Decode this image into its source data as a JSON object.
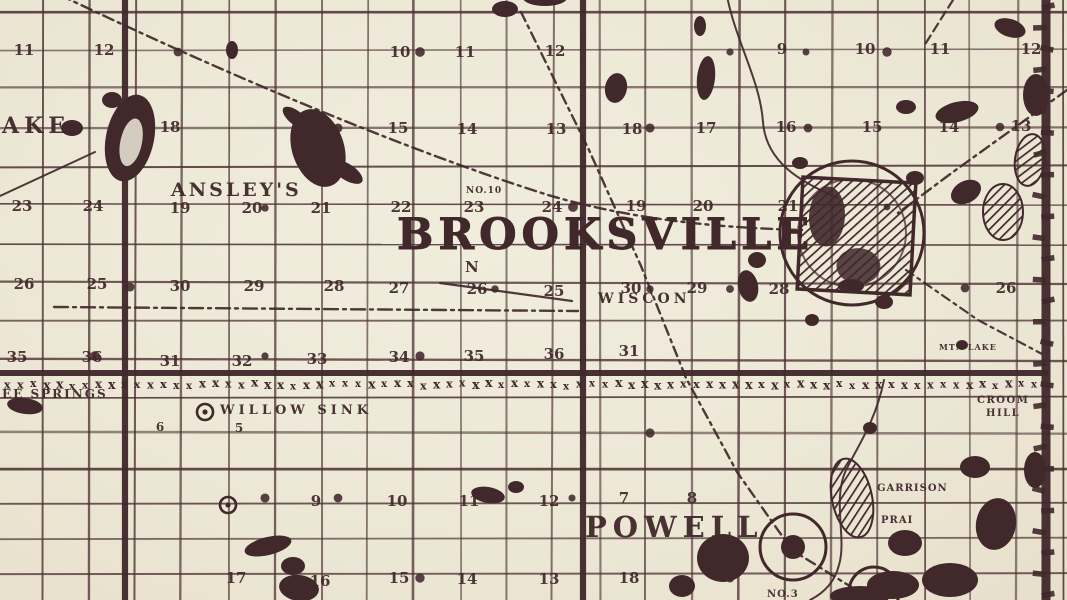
{
  "map": {
    "ink": "#40282b",
    "ink_soft": "#4d3336",
    "paper": "#efead9",
    "title_label": {
      "text": "BROOKSVILLE",
      "x": 397,
      "y": 249,
      "size": 43,
      "ls": 5
    },
    "labels": [
      {
        "id": "powell",
        "text": "POWELL",
        "x": 585,
        "y": 537,
        "size": 29,
        "ls": 6,
        "bold": true
      },
      {
        "id": "ansleys",
        "text": "ANSLEY'S",
        "x": 171,
        "y": 196,
        "size": 19,
        "ls": 3,
        "bold": true
      },
      {
        "id": "ake",
        "text": "AKE",
        "x": 2,
        "y": 133,
        "size": 22,
        "ls": 5,
        "bold": true
      },
      {
        "id": "wiscon",
        "text": "WISCON",
        "x": 598,
        "y": 303,
        "size": 14,
        "ls": 4,
        "bold": true
      },
      {
        "id": "willow-sink",
        "text": "WILLOW SINK",
        "x": 220,
        "y": 414,
        "size": 13,
        "ls": 4,
        "bold": true
      },
      {
        "id": "ee-springs",
        "text": "EE SPRINGS",
        "x": 2,
        "y": 398,
        "size": 12,
        "ls": 2,
        "bold": true
      },
      {
        "id": "croom",
        "text": "CROOM",
        "x": 977,
        "y": 403,
        "size": 10,
        "ls": 1.5,
        "bold": true
      },
      {
        "id": "hill",
        "text": "HILL",
        "x": 986,
        "y": 416,
        "size": 10,
        "ls": 1.5,
        "bold": true
      },
      {
        "id": "garrison",
        "text": "GARRISON",
        "x": 877,
        "y": 491,
        "size": 10,
        "ls": 1,
        "bold": true
      },
      {
        "id": "prai",
        "text": "PRAI",
        "x": 881,
        "y": 523,
        "size": 10,
        "ls": 1,
        "bold": true
      },
      {
        "id": "no-10",
        "text": "NO.10",
        "x": 466,
        "y": 193,
        "size": 9,
        "ls": 1,
        "bold": true
      },
      {
        "id": "no-3",
        "text": "NO.3",
        "x": 767,
        "y": 597,
        "size": 10,
        "ls": 1,
        "bold": true
      },
      {
        "id": "north",
        "text": "N",
        "x": 465,
        "y": 272,
        "size": 15,
        "ls": 0,
        "bold": true
      },
      {
        "id": "mtn-lake",
        "text": "MTN LAKE",
        "x": 939,
        "y": 350,
        "size": 8,
        "ls": 1,
        "bold": true
      }
    ],
    "section_numbers": [
      {
        "n": "11",
        "x": 16,
        "y": 50
      },
      {
        "n": "12",
        "x": 96,
        "y": 50
      },
      {
        "n": "10",
        "x": 392,
        "y": 52
      },
      {
        "n": "11",
        "x": 457,
        "y": 52
      },
      {
        "n": "12",
        "x": 547,
        "y": 51
      },
      {
        "n": "9",
        "x": 774,
        "y": 49
      },
      {
        "n": "10",
        "x": 857,
        "y": 49
      },
      {
        "n": "11",
        "x": 932,
        "y": 49
      },
      {
        "n": "12",
        "x": 1023,
        "y": 49
      },
      {
        "n": "18",
        "x": 162,
        "y": 127
      },
      {
        "n": "15",
        "x": 390,
        "y": 128
      },
      {
        "n": "14",
        "x": 459,
        "y": 129
      },
      {
        "n": "13",
        "x": 548,
        "y": 129
      },
      {
        "n": "18",
        "x": 624,
        "y": 129
      },
      {
        "n": "17",
        "x": 698,
        "y": 128
      },
      {
        "n": "16",
        "x": 778,
        "y": 127
      },
      {
        "n": "15",
        "x": 864,
        "y": 127
      },
      {
        "n": "14",
        "x": 941,
        "y": 127
      },
      {
        "n": "13",
        "x": 1013,
        "y": 126
      },
      {
        "n": "23",
        "x": 14,
        "y": 206
      },
      {
        "n": "24",
        "x": 85,
        "y": 206
      },
      {
        "n": "19",
        "x": 172,
        "y": 208
      },
      {
        "n": "20",
        "x": 244,
        "y": 208
      },
      {
        "n": "21",
        "x": 313,
        "y": 208
      },
      {
        "n": "22",
        "x": 393,
        "y": 207
      },
      {
        "n": "23",
        "x": 466,
        "y": 207
      },
      {
        "n": "24",
        "x": 544,
        "y": 207
      },
      {
        "n": "19",
        "x": 628,
        "y": 206
      },
      {
        "n": "20",
        "x": 695,
        "y": 206
      },
      {
        "n": "21",
        "x": 780,
        "y": 206
      },
      {
        "n": "26",
        "x": 16,
        "y": 284
      },
      {
        "n": "25",
        "x": 89,
        "y": 284
      },
      {
        "n": "30",
        "x": 172,
        "y": 286
      },
      {
        "n": "29",
        "x": 246,
        "y": 286
      },
      {
        "n": "28",
        "x": 326,
        "y": 286
      },
      {
        "n": "27",
        "x": 391,
        "y": 288
      },
      {
        "n": "26",
        "x": 469,
        "y": 289
      },
      {
        "n": "25",
        "x": 546,
        "y": 291
      },
      {
        "n": "30",
        "x": 623,
        "y": 288
      },
      {
        "n": "29",
        "x": 689,
        "y": 288
      },
      {
        "n": "28",
        "x": 771,
        "y": 289
      },
      {
        "n": "26",
        "x": 998,
        "y": 288
      },
      {
        "n": "35",
        "x": 9,
        "y": 357
      },
      {
        "n": "36",
        "x": 84,
        "y": 357
      },
      {
        "n": "31",
        "x": 162,
        "y": 361
      },
      {
        "n": "32",
        "x": 234,
        "y": 361
      },
      {
        "n": "33",
        "x": 309,
        "y": 359
      },
      {
        "n": "34",
        "x": 391,
        "y": 357
      },
      {
        "n": "35",
        "x": 466,
        "y": 356
      },
      {
        "n": "36",
        "x": 546,
        "y": 354
      },
      {
        "n": "31",
        "x": 621,
        "y": 351
      },
      {
        "n": "6",
        "x": 152,
        "y": 426
      },
      {
        "n": "5",
        "x": 231,
        "y": 427
      },
      {
        "n": "9",
        "x": 308,
        "y": 501
      },
      {
        "n": "10",
        "x": 389,
        "y": 501
      },
      {
        "n": "11",
        "x": 461,
        "y": 501
      },
      {
        "n": "12",
        "x": 541,
        "y": 501
      },
      {
        "n": "7",
        "x": 616,
        "y": 498
      },
      {
        "n": "8",
        "x": 684,
        "y": 498
      },
      {
        "n": "17",
        "x": 228,
        "y": 578
      },
      {
        "n": "16",
        "x": 312,
        "y": 581
      },
      {
        "n": "15",
        "x": 391,
        "y": 578
      },
      {
        "n": "14",
        "x": 459,
        "y": 579
      },
      {
        "n": "13",
        "x": 541,
        "y": 579
      },
      {
        "n": "18",
        "x": 621,
        "y": 578
      }
    ],
    "grid": {
      "cell_w": 46.4,
      "rows_upper_start": 11,
      "rows_upper_step": 38.8,
      "rows_upper_end": 362,
      "rows_lower_start": 398,
      "rows_lower_step": 35,
      "rows_lower_end": 599,
      "heavy_vertical_x": [
        125,
        583
      ],
      "county_line_x": 1046,
      "township_line_y": 373,
      "tie_row": {
        "y": 382,
        "x0": 4,
        "x1": 1038,
        "step": 13,
        "glyph": "x"
      }
    },
    "towns": {
      "brooksville_circle": {
        "cx": 852,
        "cy": 233,
        "r": 72,
        "r_inner": 54
      },
      "brooksville_square": {
        "x": 800,
        "y": 180,
        "w": 113,
        "h": 112,
        "rot": 3
      },
      "powell_circle": {
        "cx": 793,
        "cy": 547,
        "r": 33,
        "dot": 12
      },
      "powell_circle_2": {
        "cx": 874,
        "cy": 592,
        "r": 25,
        "dot": 9
      }
    },
    "wells": [
      {
        "x": 205,
        "y": 412
      },
      {
        "x": 228,
        "y": 505
      }
    ],
    "railroads": [
      {
        "d": "M 60,-5 C 200,62 390,145 548,195 C 640,222 730,228 802,230",
        "dash": "11 5 3 5",
        "w": 2.4
      },
      {
        "d": "M 521,12 L 589,150 L 641,266 L 686,378 L 737,472 L 792,550 L 872,600",
        "dash": "10 5 3 5",
        "w": 2.4
      },
      {
        "d": "M 54,307 L 578,311",
        "dash": "14 5 3 5",
        "w": 2.4
      },
      {
        "d": "M 1067,90 L 953,172 L 898,213",
        "dash": "11 5 3 5",
        "w": 2.4
      },
      {
        "d": "M 906,270 L 978,320 L 1042,354",
        "dash": "9 5 3 5",
        "w": 2.2
      },
      {
        "d": "M 953,0 L 924,46",
        "dash": "9 5",
        "w": 2.2
      },
      {
        "d": "M 95,152 L 0,196",
        "dash": "",
        "w": 2
      },
      {
        "d": "M 440,283 L 572,301",
        "dash": "",
        "w": 2.2
      },
      {
        "d": "M 727,-4 C 736,42 760,80 763,122 C 766,162 800,182 838,198",
        "dash": "",
        "w": 2
      },
      {
        "d": "M 884,380 C 876,420 858,446 846,470 C 832,500 847,538 839,565 C 834,585 820,595 810,600",
        "dash": "",
        "w": 2
      }
    ],
    "blobs": [
      {
        "x": 72,
        "y": 128,
        "rx": 11,
        "ry": 8,
        "rot": 0
      },
      {
        "x": 130,
        "y": 138,
        "rx": 24,
        "ry": 44,
        "rot": 12,
        "hole": true
      },
      {
        "x": 112,
        "y": 100,
        "rx": 10,
        "ry": 8,
        "rot": 0
      },
      {
        "x": 318,
        "y": 148,
        "rx": 26,
        "ry": 40,
        "rot": -18
      },
      {
        "x": 296,
        "y": 118,
        "rx": 16,
        "ry": 7,
        "rot": 38
      },
      {
        "x": 347,
        "y": 172,
        "rx": 18,
        "ry": 8,
        "rot": 33
      },
      {
        "x": 232,
        "y": 50,
        "rx": 6,
        "ry": 9,
        "rot": 0
      },
      {
        "x": 505,
        "y": 9,
        "rx": 13,
        "ry": 8,
        "rot": 0
      },
      {
        "x": 545,
        "y": -2,
        "rx": 22,
        "ry": 8,
        "rot": 0
      },
      {
        "x": 616,
        "y": 88,
        "rx": 11,
        "ry": 15,
        "rot": 10
      },
      {
        "x": 706,
        "y": 78,
        "rx": 9,
        "ry": 22,
        "rot": 6
      },
      {
        "x": 700,
        "y": 26,
        "rx": 6,
        "ry": 10,
        "rot": 0
      },
      {
        "x": 757,
        "y": 260,
        "rx": 9,
        "ry": 8,
        "rot": 0
      },
      {
        "x": 748,
        "y": 286,
        "rx": 10,
        "ry": 16,
        "rot": -12
      },
      {
        "x": 851,
        "y": 286,
        "rx": 13,
        "ry": 7,
        "rot": 0
      },
      {
        "x": 906,
        "y": 107,
        "rx": 10,
        "ry": 7,
        "rot": 0
      },
      {
        "x": 957,
        "y": 112,
        "rx": 22,
        "ry": 10,
        "rot": -14
      },
      {
        "x": 1010,
        "y": 28,
        "rx": 16,
        "ry": 9,
        "rot": 18
      },
      {
        "x": 1036,
        "y": 95,
        "rx": 13,
        "ry": 21,
        "rot": 0
      },
      {
        "x": 1030,
        "y": 160,
        "rx": 15,
        "ry": 26,
        "rot": 8,
        "hatch": true
      },
      {
        "x": 1003,
        "y": 212,
        "rx": 20,
        "ry": 28,
        "rot": 0,
        "hatch": true
      },
      {
        "x": 966,
        "y": 192,
        "rx": 16,
        "ry": 11,
        "rot": -28
      },
      {
        "x": 800,
        "y": 163,
        "rx": 8,
        "ry": 6,
        "rot": 0
      },
      {
        "x": 915,
        "y": 178,
        "rx": 9,
        "ry": 7,
        "rot": 0
      },
      {
        "x": 884,
        "y": 302,
        "rx": 9,
        "ry": 7,
        "rot": 0
      },
      {
        "x": 812,
        "y": 320,
        "rx": 7,
        "ry": 6,
        "rot": 0
      },
      {
        "x": 488,
        "y": 495,
        "rx": 17,
        "ry": 8,
        "rot": 10
      },
      {
        "x": 516,
        "y": 487,
        "rx": 8,
        "ry": 6,
        "rot": 0
      },
      {
        "x": 852,
        "y": 498,
        "rx": 20,
        "ry": 40,
        "rot": -12,
        "hatch": true
      },
      {
        "x": 723,
        "y": 558,
        "rx": 26,
        "ry": 24,
        "rot": 0
      },
      {
        "x": 682,
        "y": 586,
        "rx": 13,
        "ry": 11,
        "rot": 0
      },
      {
        "x": 905,
        "y": 543,
        "rx": 17,
        "ry": 13,
        "rot": 0
      },
      {
        "x": 950,
        "y": 580,
        "rx": 28,
        "ry": 17,
        "rot": 0
      },
      {
        "x": 996,
        "y": 524,
        "rx": 20,
        "ry": 26,
        "rot": 10
      },
      {
        "x": 975,
        "y": 467,
        "rx": 15,
        "ry": 11,
        "rot": 0
      },
      {
        "x": 1035,
        "y": 470,
        "rx": 11,
        "ry": 18,
        "rot": 0
      },
      {
        "x": 870,
        "y": 428,
        "rx": 7,
        "ry": 6,
        "rot": 0
      },
      {
        "x": 25,
        "y": 406,
        "rx": 18,
        "ry": 8,
        "rot": 8
      },
      {
        "x": 268,
        "y": 546,
        "rx": 24,
        "ry": 9,
        "rot": -14
      },
      {
        "x": 293,
        "y": 566,
        "rx": 12,
        "ry": 9,
        "rot": 0
      },
      {
        "x": 299,
        "y": 588,
        "rx": 20,
        "ry": 13,
        "rot": 8
      },
      {
        "x": 962,
        "y": 345,
        "rx": 6,
        "ry": 5,
        "rot": 0
      },
      {
        "x": 893,
        "y": 585,
        "rx": 26,
        "ry": 14,
        "rot": 0
      },
      {
        "x": 860,
        "y": 596,
        "rx": 30,
        "ry": 10,
        "rot": 0
      }
    ],
    "dots": [
      {
        "x": 338,
        "y": 128
      },
      {
        "x": 420,
        "y": 52
      },
      {
        "x": 265,
        "y": 208
      },
      {
        "x": 495,
        "y": 289
      },
      {
        "x": 573,
        "y": 207
      },
      {
        "x": 650,
        "y": 128
      },
      {
        "x": 650,
        "y": 289
      },
      {
        "x": 730,
        "y": 52
      },
      {
        "x": 808,
        "y": 128
      },
      {
        "x": 887,
        "y": 207
      },
      {
        "x": 887,
        "y": 52
      },
      {
        "x": 965,
        "y": 288
      },
      {
        "x": 420,
        "y": 356
      },
      {
        "x": 265,
        "y": 356
      },
      {
        "x": 730,
        "y": 289
      },
      {
        "x": 130,
        "y": 287
      },
      {
        "x": 95,
        "y": 356
      },
      {
        "x": 1000,
        "y": 127
      },
      {
        "x": 338,
        "y": 498
      },
      {
        "x": 420,
        "y": 578
      },
      {
        "x": 265,
        "y": 498
      },
      {
        "x": 650,
        "y": 433
      },
      {
        "x": 730,
        "y": 578
      },
      {
        "x": 572,
        "y": 498
      },
      {
        "x": 806,
        "y": 52
      },
      {
        "x": 178,
        "y": 52
      }
    ]
  }
}
